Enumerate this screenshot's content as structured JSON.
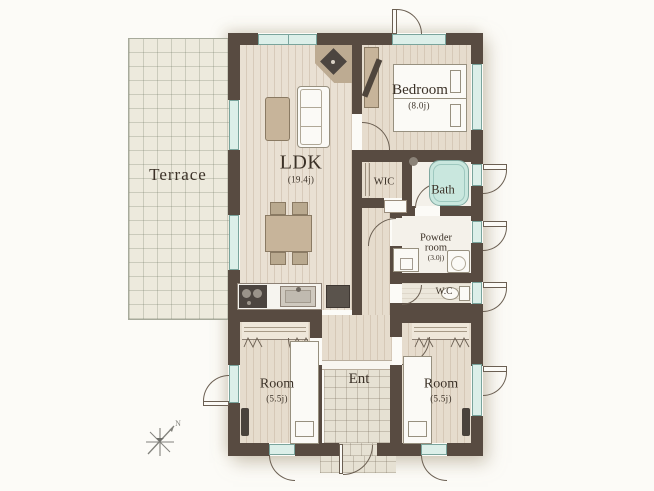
{
  "rooms": {
    "terrace": {
      "name": "Terrace"
    },
    "ldk": {
      "name": "LDK",
      "area": "(19.4j)"
    },
    "bedroom": {
      "name": "Bedroom",
      "area": "(8.0j)"
    },
    "wic": {
      "name": "WIC"
    },
    "bath": {
      "name": "Bath"
    },
    "powder_room": {
      "name_line1": "Powder",
      "name_line2": "room",
      "area": "(3.0j)"
    },
    "wc": {
      "name": "W.C"
    },
    "room_sw": {
      "name": "Room",
      "area": "(5.5j)"
    },
    "room_se": {
      "name": "Room",
      "area": "(5.5j)"
    },
    "ent": {
      "name": "Ent"
    }
  },
  "compass": {
    "north": "N"
  },
  "colors": {
    "wall": "#584b41",
    "window_glass": "#dcefe9",
    "window_frame": "#79a49c",
    "bathtub": "#c9e7de",
    "wood_floor": "#e9e0d3",
    "terrace_tile": "#edeadd",
    "furniture_tan": "#c7b49a",
    "appliance_dark": "#4c4540",
    "label_text": "#3b3127"
  }
}
